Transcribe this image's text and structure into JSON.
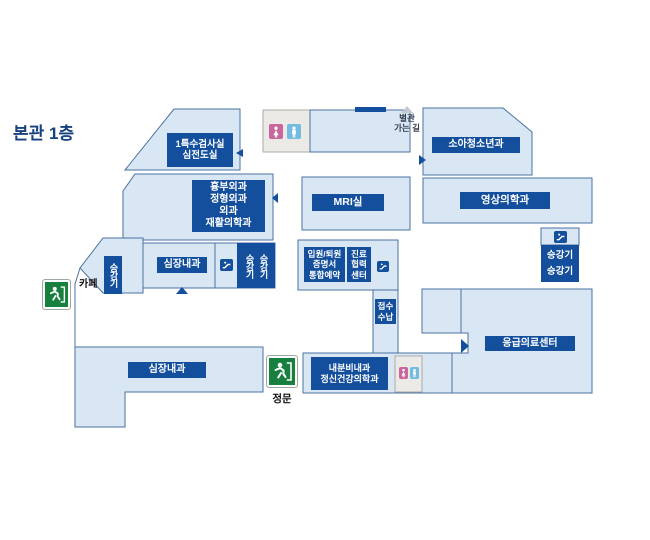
{
  "title": "본관 1층",
  "colors": {
    "room_fill": "#d9e7f5",
    "room_border": "#4a71a1",
    "label_bg": "#134f9c",
    "title_color": "#16407e",
    "exit_green": "#17803f",
    "female_pink": "#c9679c",
    "male_blue": "#73bce0",
    "restroom_bg": "#eceae7",
    "annex_text": "#333f4f",
    "arrow_gray": "#c3c9cf"
  },
  "labels": {
    "special_exam": {
      "line1": "1특수검사실",
      "line2": "심전도실"
    },
    "surgery": {
      "line1": "흉부외과",
      "line2": "정형외과",
      "line3": "외과",
      "line4": "재활의학과"
    },
    "cardiology_upper": "심장내과",
    "cardiology_lower": "심장내과",
    "elevator": "승강기",
    "cafe": "카페",
    "mri": "MRI실",
    "admission": {
      "line1": "입원/퇴원",
      "line2": "증명서",
      "line3": "통합예약"
    },
    "cooperation": {
      "line1": "진료",
      "line2": "협력",
      "line3": "센터"
    },
    "reception": {
      "line1": "접수",
      "line2": "수납"
    },
    "pediatrics": "소아청소년과",
    "radiology": "영상의학과",
    "elevator_right": {
      "line1": "승강기",
      "line2": "승강기"
    },
    "emergency": "응급의료센터",
    "endocrine": {
      "line1": "내분비내과",
      "line2": "정신건강의학과"
    },
    "annex": {
      "line1": "별관",
      "line2": "가는 길"
    },
    "main_gate": "정문"
  },
  "icons": {
    "escalator": "escalator-icon",
    "exit": "emergency-exit-icon",
    "female_restroom": "female-restroom-icon",
    "male_restroom": "male-restroom-icon",
    "direction_arrow": "direction-arrow-icon"
  }
}
